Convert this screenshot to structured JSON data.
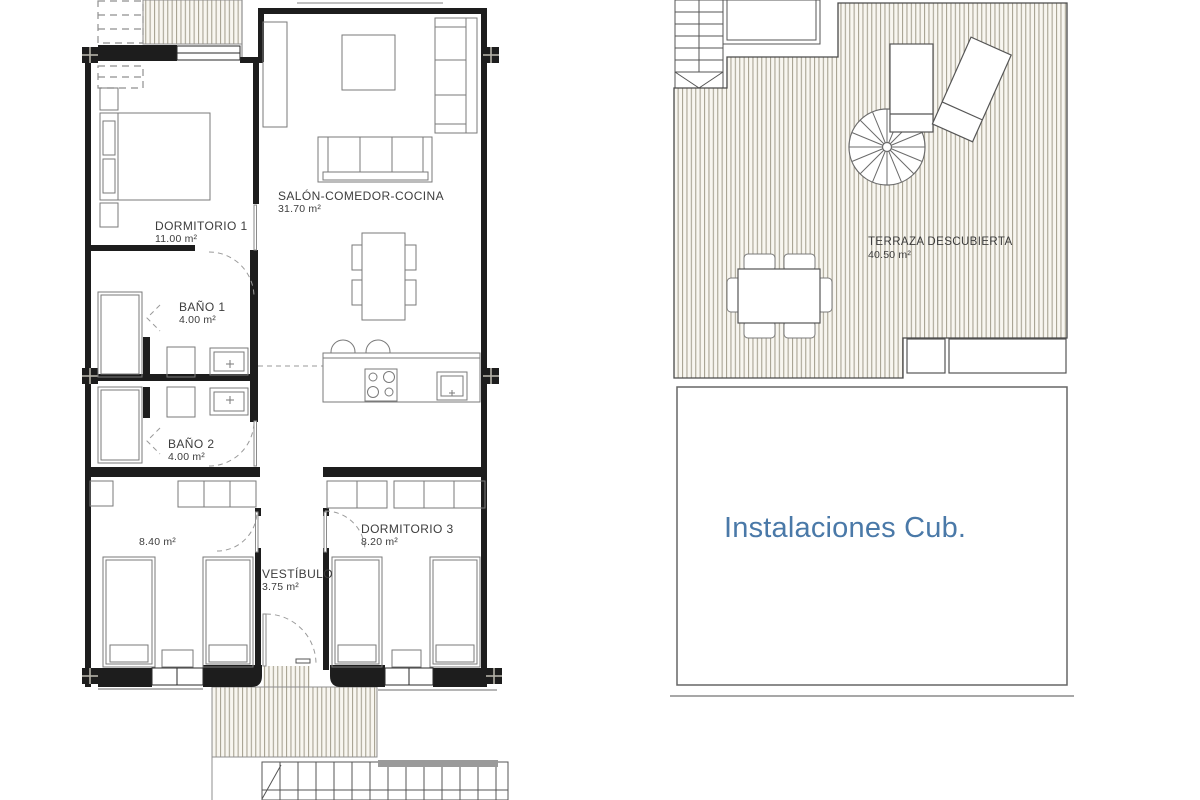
{
  "canvas": {
    "width": 1200,
    "height": 800,
    "background": "#ffffff"
  },
  "colors": {
    "wall": "#1d1d1d",
    "furniture_line": "#7a7a7a",
    "hatch_line": "#a9a494",
    "hatch_bg": "#f8f6f0",
    "label_text": "#3d3d3d",
    "instalaciones_blue": "#4a79a8",
    "stairs_bar": "#9a9a9a"
  },
  "symbols": {
    "column_marker": "filled-square-with-cross",
    "spiral_staircase": "circle-with-radial-spokes",
    "door_swing": "dashed-quarter-arc",
    "decking": "vertical-stripe-hatch"
  },
  "floor_plan": {
    "rooms": [
      {
        "id": "salon",
        "label": "SALÓN-COMEDOR-COCINA",
        "area": "31.70 m²"
      },
      {
        "id": "dormitorio1",
        "label": "DORMITORIO 1",
        "area": "11.00 m²"
      },
      {
        "id": "bano1",
        "label": "BAÑO 1",
        "area": "4.00 m²"
      },
      {
        "id": "bano2",
        "label": "BAÑO 2",
        "area": "4.00 m²"
      },
      {
        "id": "dormitorio2",
        "label": "",
        "area": "8.40 m²"
      },
      {
        "id": "dormitorio3",
        "label": "DORMITORIO 3",
        "area": "8.20 m²"
      },
      {
        "id": "vestibulo",
        "label": "VESTÍBULO",
        "area": "3.75 m²"
      }
    ]
  },
  "roof_plan": {
    "terraza": {
      "label": "TERRAZA DESCUBIERTA",
      "area": "40.50 m²"
    },
    "instalaciones": {
      "label": "Instalaciones Cub."
    }
  }
}
